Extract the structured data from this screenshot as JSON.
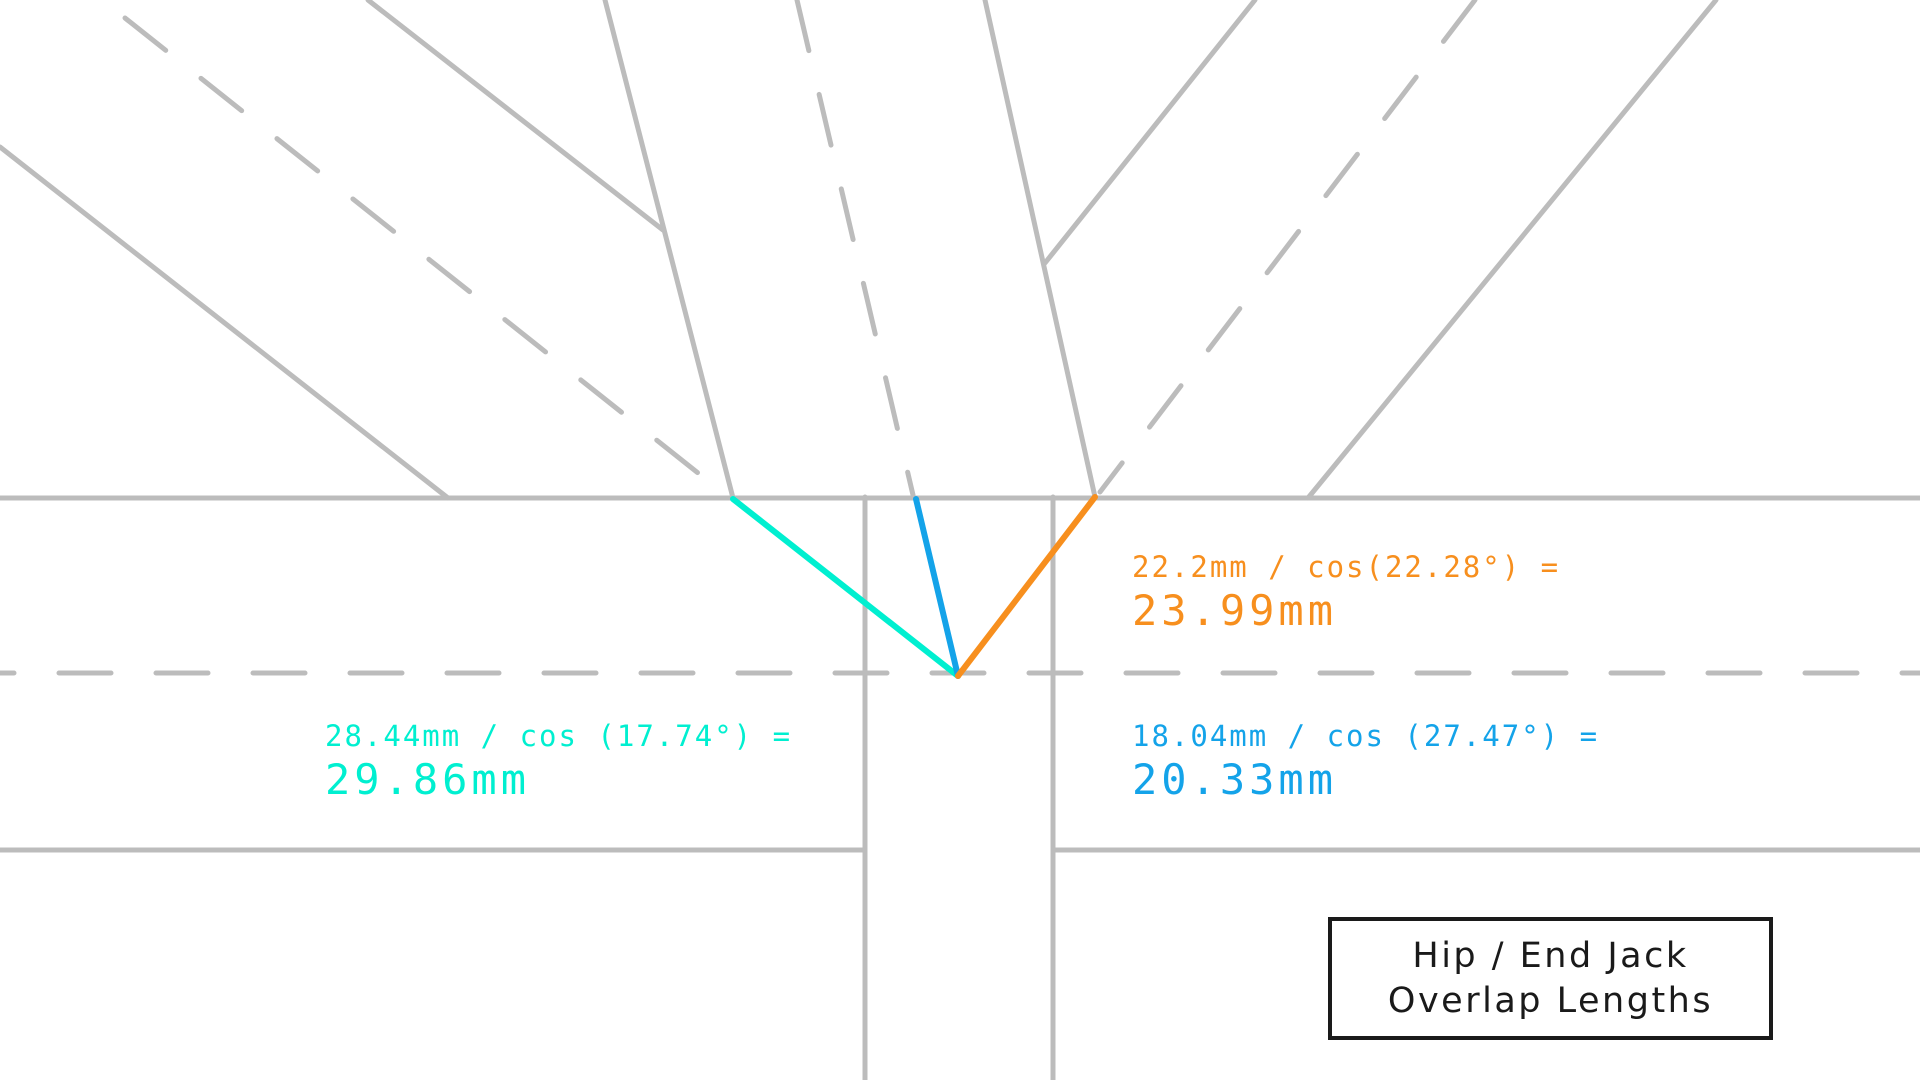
{
  "canvas": {
    "width": 1920,
    "height": 1080,
    "background": "#ffffff"
  },
  "colors": {
    "gray": "#bcbcbc",
    "cyan": "#00efd0",
    "blue": "#14a3e9",
    "orange": "#f78f1e",
    "ink": "#1a1a1a"
  },
  "geometry": {
    "gray_stroke_width": 5,
    "overlap_stroke_width": 6,
    "dash_pattern": "52 45",
    "lines": [
      {
        "name": "fascia-top-edge-line",
        "x1": 0,
        "y1": 498,
        "x2": 1920,
        "y2": 498,
        "style": "solid",
        "color": "gray"
      },
      {
        "name": "fascia-bottom-edge-left-line",
        "x1": 0,
        "y1": 850,
        "x2": 865,
        "y2": 850,
        "style": "solid",
        "color": "gray"
      },
      {
        "name": "fascia-bottom-edge-right-line",
        "x1": 1053,
        "y1": 850,
        "x2": 1920,
        "y2": 850,
        "style": "solid",
        "color": "gray"
      },
      {
        "name": "vertical-member-left-edge-line",
        "x1": 865,
        "y1": 497,
        "x2": 865,
        "y2": 1080,
        "style": "solid",
        "color": "gray"
      },
      {
        "name": "vertical-member-right-edge-line",
        "x1": 1053,
        "y1": 497,
        "x2": 1053,
        "y2": 1080,
        "style": "solid",
        "color": "gray"
      },
      {
        "name": "left-jack-rafter-top-edge-line",
        "x1": 368,
        "y1": 0,
        "x2": 663,
        "y2": 230,
        "style": "solid",
        "color": "gray"
      },
      {
        "name": "left-jack-rafter-bottom-edge-line",
        "x1": 0,
        "y1": 147,
        "x2": 448,
        "y2": 498,
        "style": "solid",
        "color": "gray"
      },
      {
        "name": "center-rafter-left-edge-line",
        "x1": 605,
        "y1": 0,
        "x2": 733,
        "y2": 498,
        "style": "solid",
        "color": "gray"
      },
      {
        "name": "center-rafter-right-edge-line",
        "x1": 985,
        "y1": 0,
        "x2": 1095,
        "y2": 497,
        "style": "solid",
        "color": "gray"
      },
      {
        "name": "right-jack-rafter-left-edge-line",
        "x1": 1255,
        "y1": 0,
        "x2": 1045,
        "y2": 263,
        "style": "solid",
        "color": "gray"
      },
      {
        "name": "right-jack-rafter-right-edge-line",
        "x1": 1716,
        "y1": 0,
        "x2": 1308,
        "y2": 498,
        "style": "solid",
        "color": "gray"
      },
      {
        "name": "left-jack-rafter-centerline-dashed",
        "x1": 125,
        "y1": 18,
        "x2": 727,
        "y2": 496,
        "style": "dashed",
        "color": "gray"
      },
      {
        "name": "center-rafter-centerline-dashed",
        "x1": 797,
        "y1": 0,
        "x2": 913,
        "y2": 495,
        "style": "dashed",
        "color": "gray"
      },
      {
        "name": "right-jack-rafter-centerline-dashed",
        "x1": 1475,
        "y1": 0,
        "x2": 1100,
        "y2": 492,
        "style": "dashed",
        "color": "gray"
      },
      {
        "name": "fascia-centerline-dashed",
        "x1": 0,
        "y1": 673,
        "x2": 1920,
        "y2": 673,
        "style": "dashed",
        "color": "gray",
        "dashoffset": -59
      },
      {
        "name": "cyan-overlap-line",
        "x1": 733,
        "y1": 499,
        "x2": 958,
        "y2": 676,
        "style": "overlap",
        "color": "cyan"
      },
      {
        "name": "blue-overlap-line",
        "x1": 916,
        "y1": 499,
        "x2": 958,
        "y2": 676,
        "style": "overlap",
        "color": "blue"
      },
      {
        "name": "orange-overlap-line",
        "x1": 1095,
        "y1": 497,
        "x2": 958,
        "y2": 676,
        "style": "overlap",
        "color": "orange"
      }
    ]
  },
  "labels": {
    "cyan_overlap": {
      "formula": "28.44mm / cos (17.74°) =",
      "result": "29.86mm",
      "x": 325,
      "y": 720,
      "color": "cyan"
    },
    "orange_overlap": {
      "formula": "22.2mm / cos(22.28°) =",
      "result": "23.99mm",
      "x": 1132,
      "y": 551,
      "color": "orange"
    },
    "blue_overlap": {
      "formula": "18.04mm / cos (27.47°) =",
      "result": "20.33mm",
      "x": 1132,
      "y": 720,
      "color": "blue"
    }
  },
  "title_box": {
    "line1": "Hip / End Jack",
    "line2": "Overlap Lengths",
    "x": 1328,
    "y": 917,
    "width": 445,
    "height": 123
  }
}
